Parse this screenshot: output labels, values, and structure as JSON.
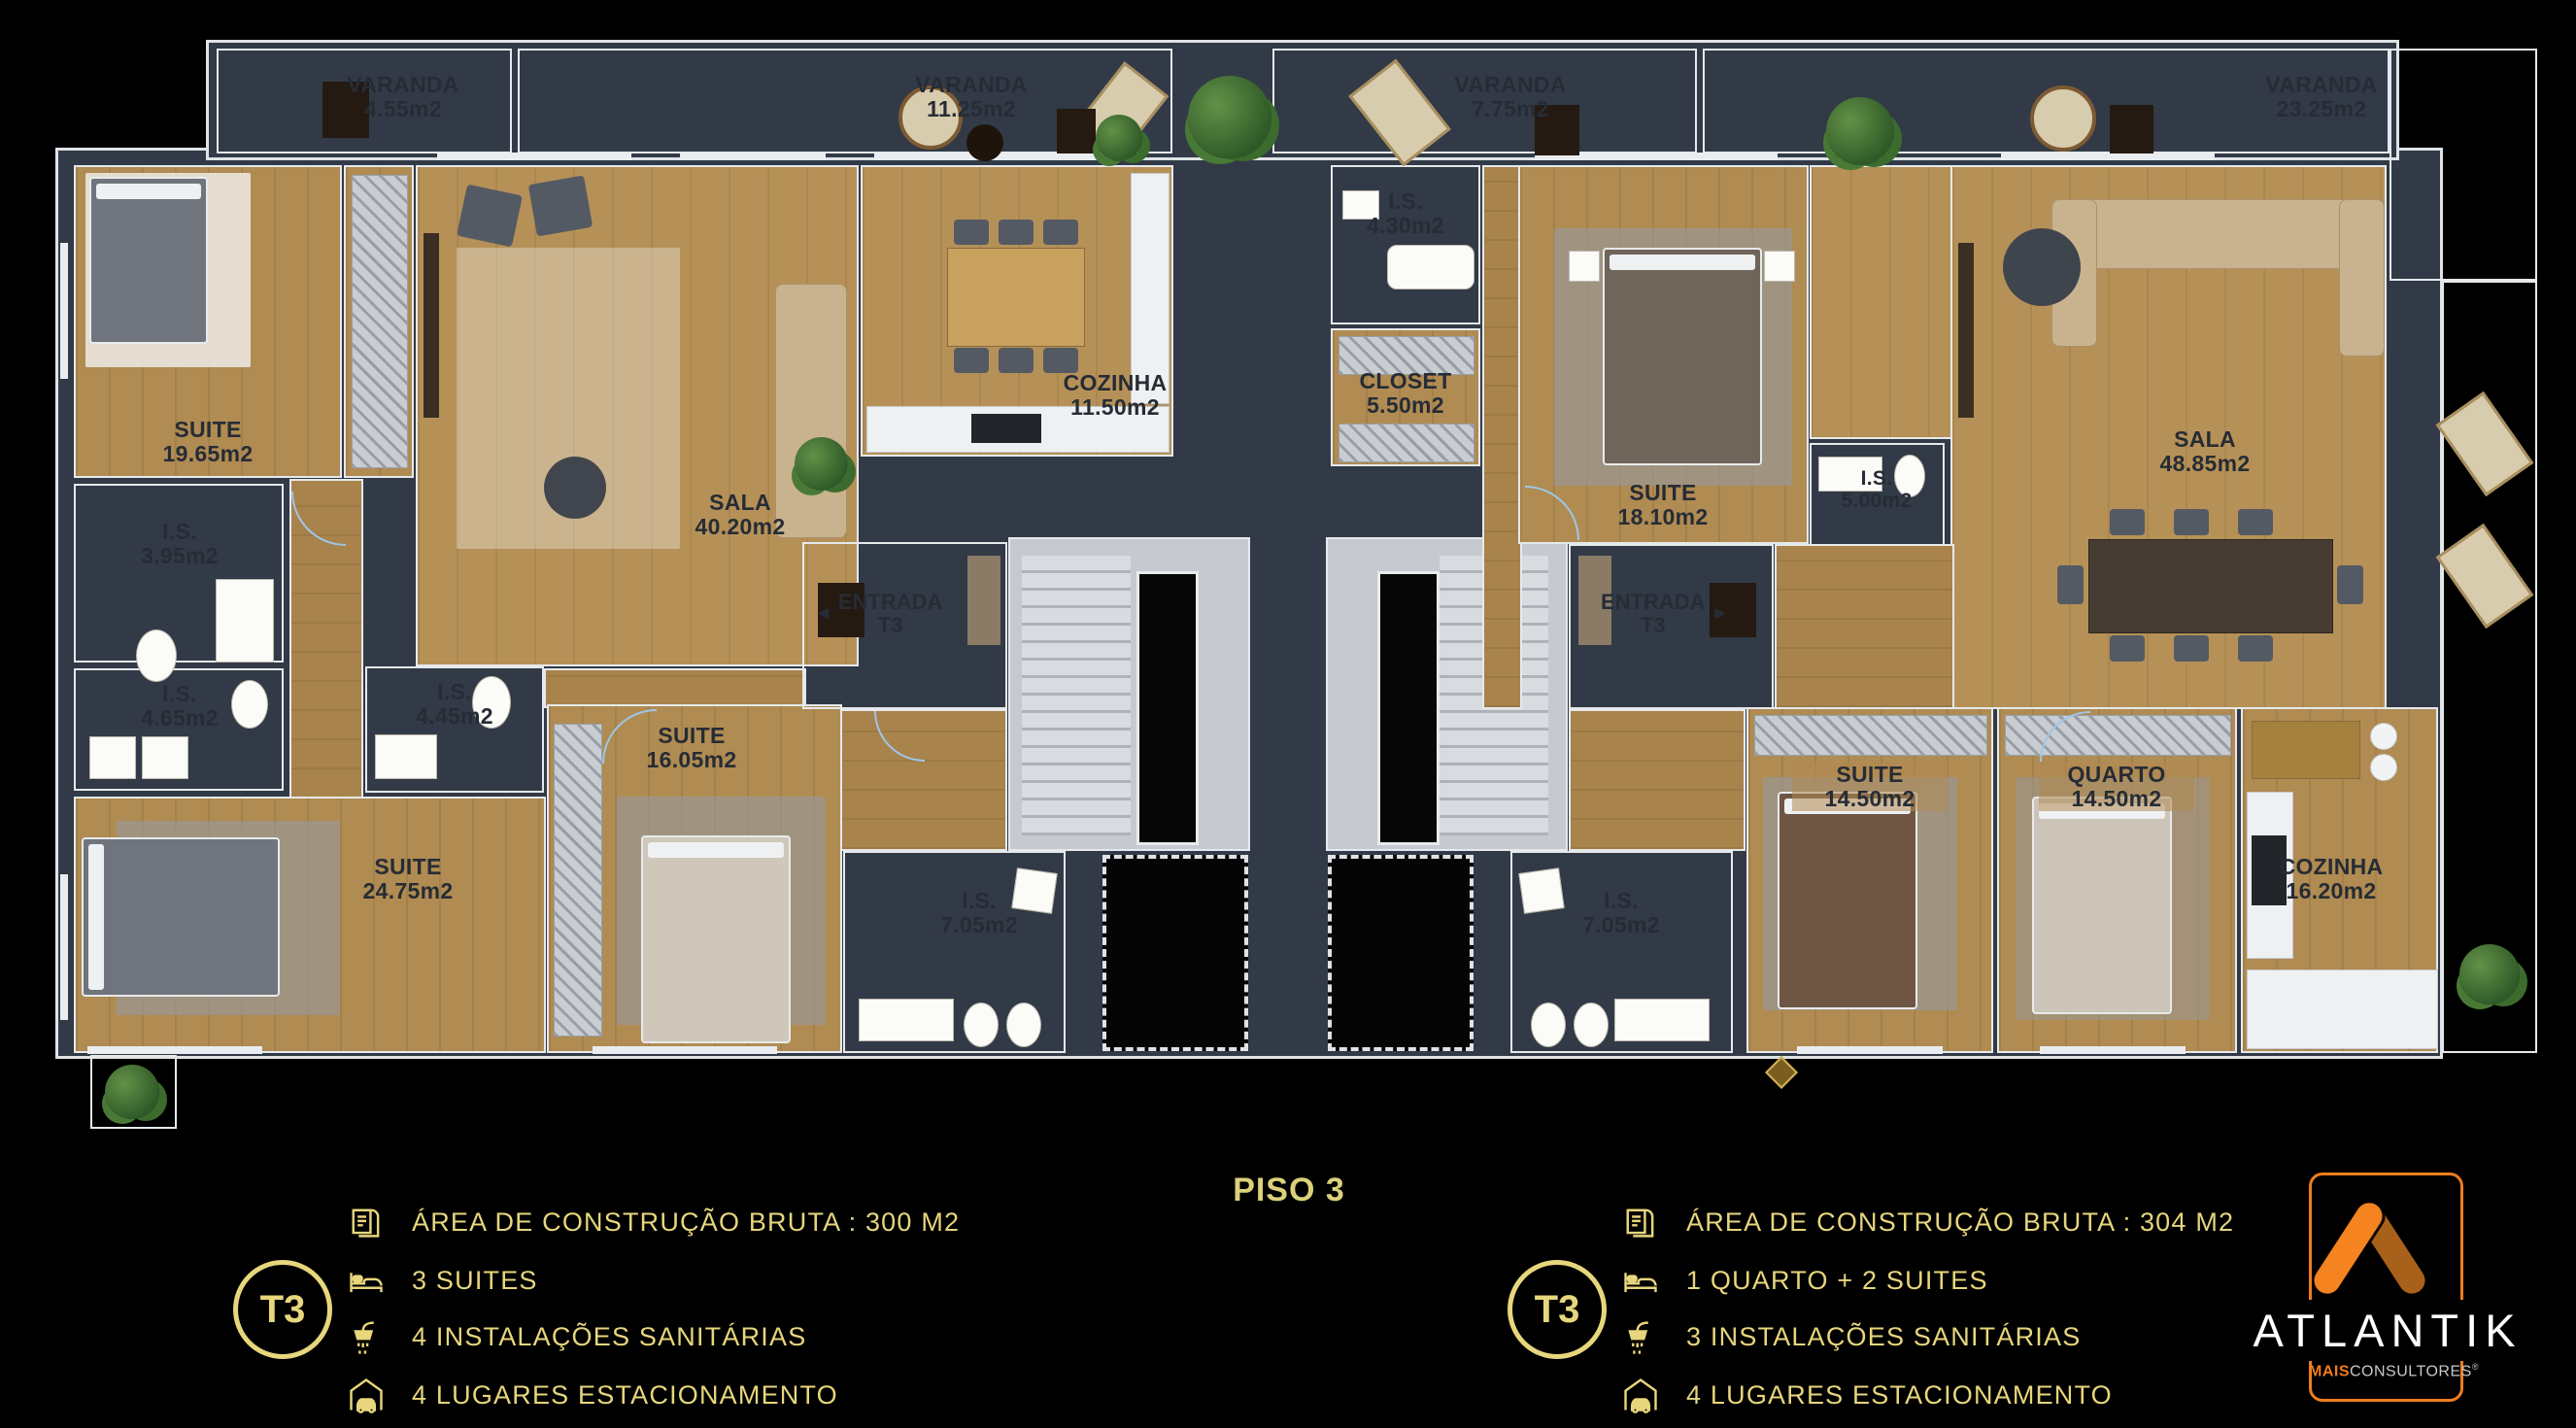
{
  "title": "PISO 3",
  "colors": {
    "accent_gold": "#e7d67c",
    "brand_orange": "#ee7d1e",
    "wall": "#313a46",
    "wood_floor": "#b08b52",
    "bath_tile": "#ded8ca",
    "hall_tile": "#c7ccd2",
    "balcony_concrete": "#ccd3d1"
  },
  "plan": {
    "balconies": [
      {
        "name": "VARANDA",
        "area": "4.55m2"
      },
      {
        "name": "VARANDA",
        "area": "11.25m2"
      },
      {
        "name": "VARANDA",
        "area": "7.75m2"
      },
      {
        "name": "VARANDA",
        "area": "23.25m2"
      }
    ],
    "left_unit": {
      "rooms": [
        {
          "name": "SUITE",
          "area": "19.65m2"
        },
        {
          "name": "I.S.",
          "area": "3.95m2"
        },
        {
          "name": "I.S.",
          "area": "4.65m2"
        },
        {
          "name": "I.S.",
          "area": "4.45m2"
        },
        {
          "name": "SUITE",
          "area": "24.75m2"
        },
        {
          "name": "SUITE",
          "area": "16.05m2"
        },
        {
          "name": "SALA",
          "area": "40.20m2"
        },
        {
          "name": "COZINHA",
          "area": "11.50m2"
        },
        {
          "name": "ENTRADA",
          "area": "T3",
          "arrow": "◄"
        },
        {
          "name": "I.S.",
          "area": "7.05m2"
        }
      ]
    },
    "right_unit": {
      "rooms": [
        {
          "name": "I.S.",
          "area": "4.30m2"
        },
        {
          "name": "CLOSET",
          "area": "5.50m2"
        },
        {
          "name": "SUITE",
          "area": "18.10m2"
        },
        {
          "name": "I.S.",
          "area": "5.00m2"
        },
        {
          "name": "ENTRADA",
          "area": "T3",
          "arrow": "►"
        },
        {
          "name": "I.S.",
          "area": "7.05m2"
        },
        {
          "name": "SUITE",
          "area": "14.50m2"
        },
        {
          "name": "QUARTO",
          "area": "14.50m2"
        },
        {
          "name": "SALA",
          "area": "48.85m2"
        },
        {
          "name": "COZINHA",
          "area": "16.20m2"
        }
      ]
    }
  },
  "legends": {
    "left": {
      "badge": "T3",
      "items": [
        {
          "icon": "blueprint-icon",
          "text": "ÁREA DE CONSTRUÇÃO BRUTA :  300 M2"
        },
        {
          "icon": "bed-icon",
          "text": "3 SUITES"
        },
        {
          "icon": "shower-icon",
          "text": "4 INSTALAÇÕES SANITÁRIAS"
        },
        {
          "icon": "garage-car-icon",
          "text": "4 LUGARES ESTACIONAMENTO"
        }
      ]
    },
    "right": {
      "badge": "T3",
      "items": [
        {
          "icon": "blueprint-icon",
          "text": "ÁREA DE CONSTRUÇÃO BRUTA :  304 M2"
        },
        {
          "icon": "bed-icon",
          "text": "1 QUARTO + 2 SUITES"
        },
        {
          "icon": "shower-icon",
          "text": "3 INSTALAÇÕES SANITÁRIAS"
        },
        {
          "icon": "garage-car-icon",
          "text": "4 LUGARES ESTACIONAMENTO"
        }
      ]
    }
  },
  "brand": {
    "name": "ATLANTIK",
    "sub_bold": "MAIS",
    "sub_rest": "CONSULTORES",
    "registered": "®"
  }
}
